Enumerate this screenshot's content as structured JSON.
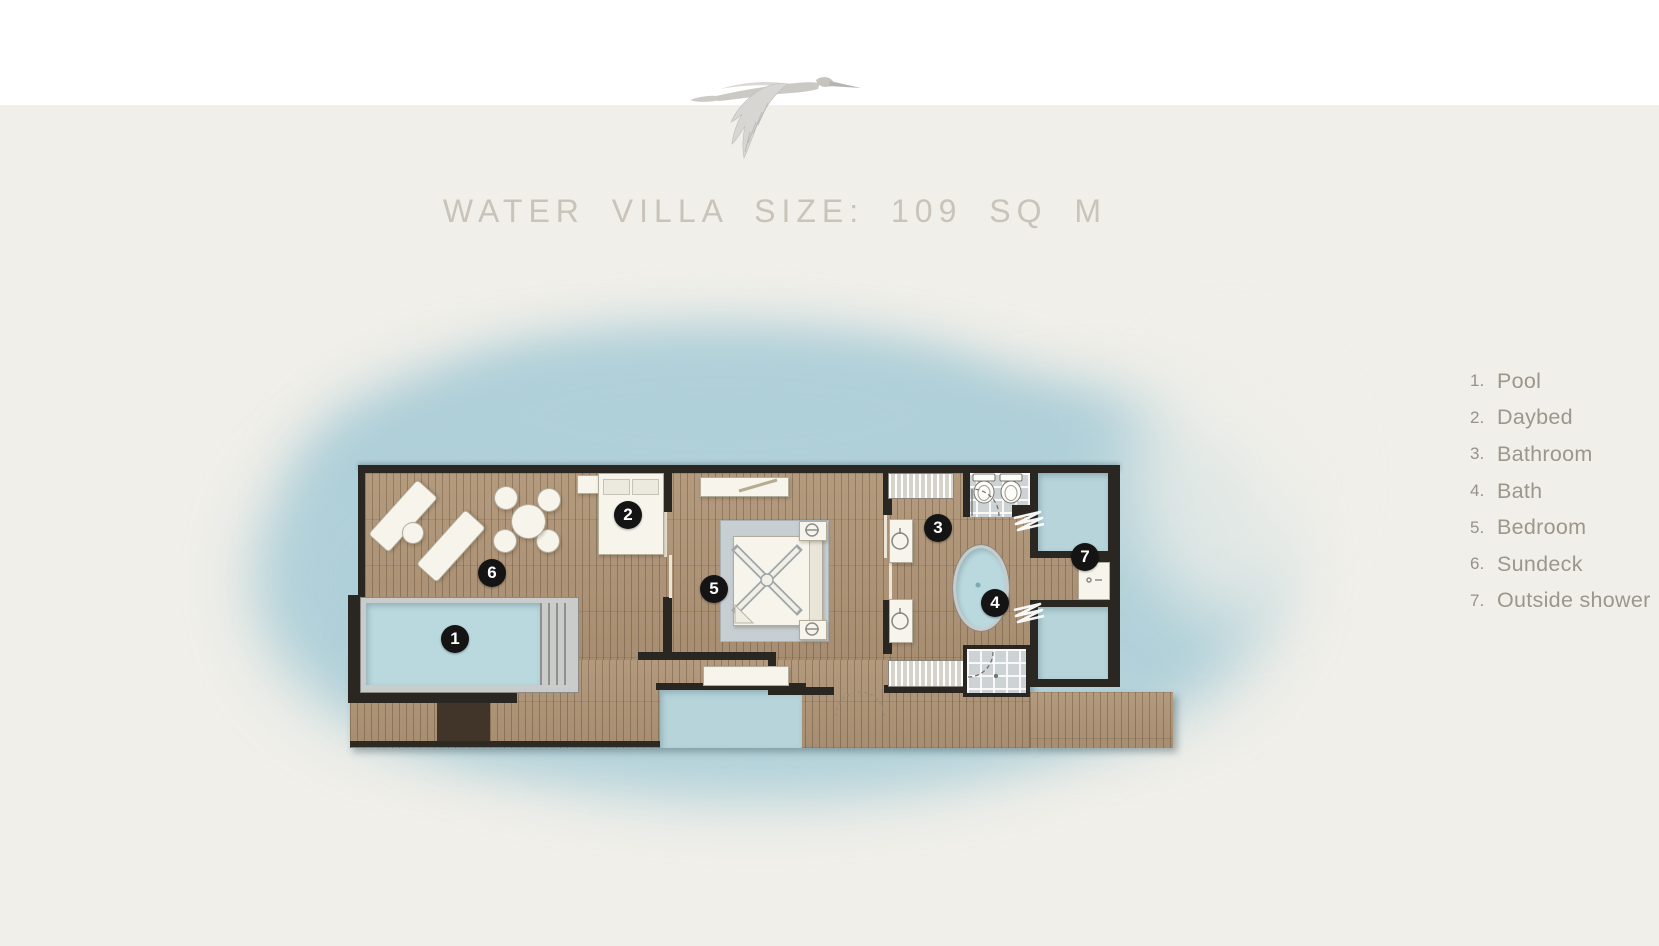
{
  "header": {
    "title": "WATER VILLA SIZE: 109 SQ M"
  },
  "legend": {
    "items": [
      {
        "num": "1.",
        "label": "Pool"
      },
      {
        "num": "2.",
        "label": "Daybed"
      },
      {
        "num": "3.",
        "label": "Bathroom"
      },
      {
        "num": "4.",
        "label": "Bath"
      },
      {
        "num": "5.",
        "label": "Bedroom"
      },
      {
        "num": "6.",
        "label": "Sundeck"
      },
      {
        "num": "7.",
        "label": "Outside shower"
      }
    ]
  },
  "plan": {
    "markers": [
      {
        "n": "1",
        "name": "pool"
      },
      {
        "n": "2",
        "name": "daybed"
      },
      {
        "n": "3",
        "name": "bathroom"
      },
      {
        "n": "4",
        "name": "bath"
      },
      {
        "n": "5",
        "name": "bedroom"
      },
      {
        "n": "6",
        "name": "sundeck"
      },
      {
        "n": "7",
        "name": "outside-shower"
      }
    ]
  },
  "palette": {
    "page_background": "#f0efe9",
    "top_bar": "#ffffff",
    "water_shadow": "#aecfd8",
    "deck_wood": "#b09577",
    "walls": "#2a2722",
    "pool_water": "#b9d9de",
    "marker_background": "#141414",
    "marker_text": "#ffffff",
    "title_text": "#c9c4ba",
    "legend_text": "#9c978d"
  }
}
